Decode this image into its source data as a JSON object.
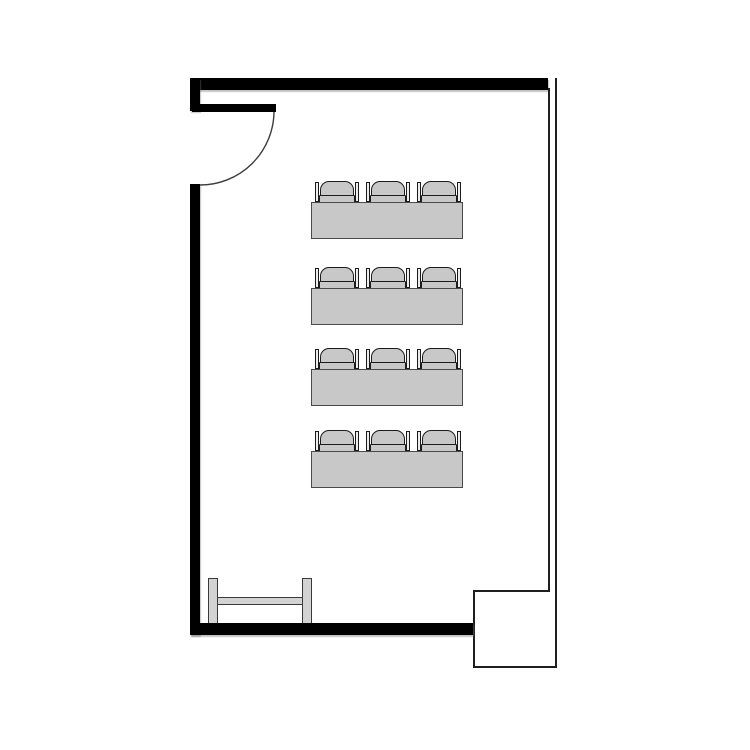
{
  "scene": {
    "kind": "floor-plan",
    "room": "classroom",
    "background": "#ffffff",
    "canvas": {
      "width": 750,
      "height": 750
    }
  },
  "palette": {
    "wall": "#000000",
    "thin_line": "#1f1f1f",
    "door_arc": "#3c3c3c",
    "furniture_fill": "#c8c8c8",
    "furniture_border": "#4a4a4a",
    "chair_border": "#1b1b1b",
    "armrest_fill": "#ededed",
    "bench_fill": "#d3d3d3",
    "bench_border": "#3a3a3a"
  },
  "walls": {
    "top": {
      "x": 190,
      "y": 78,
      "w": 358,
      "h": 12,
      "thick": true
    },
    "left_upper": {
      "x": 190,
      "y": 78,
      "w": 10,
      "h": 33,
      "thick": true
    },
    "left_lower": {
      "x": 190,
      "y": 184,
      "w": 10,
      "h": 451,
      "thick": true
    },
    "bottom": {
      "x": 190,
      "y": 623,
      "w": 283,
      "h": 12,
      "thick": true
    },
    "right_inner": {
      "x": 548,
      "y": 88,
      "w": 2,
      "h": 503,
      "thick": false
    },
    "right_outer": {
      "x": 555,
      "y": 78,
      "w": 2,
      "h": 590,
      "thick": false
    }
  },
  "door": {
    "panel": {
      "x": 192,
      "y": 104,
      "w": 84,
      "h": 8
    },
    "swing_arc": {
      "cx": 200,
      "cy": 111,
      "r": 74
    }
  },
  "alcove": {
    "top_edge": {
      "x": 473,
      "y": 590,
      "w": 77,
      "h": 2
    },
    "left_edge": {
      "x": 473,
      "y": 590,
      "w": 2,
      "h": 78
    },
    "bottom_edge": {
      "x": 473,
      "y": 666,
      "w": 84,
      "h": 2
    }
  },
  "seating": {
    "rows": [
      {
        "table": {
          "x": 311,
          "y": 202,
          "w": 152,
          "h": 37
        },
        "chairs": 3
      },
      {
        "table": {
          "x": 311,
          "y": 288,
          "w": 152,
          "h": 37
        },
        "chairs": 3
      },
      {
        "table": {
          "x": 311,
          "y": 369,
          "w": 152,
          "h": 37
        },
        "chairs": 3
      },
      {
        "table": {
          "x": 311,
          "y": 451,
          "w": 152,
          "h": 37
        },
        "chairs": 3
      }
    ],
    "chair": {
      "w": 44,
      "h": 22,
      "offsets": [
        4,
        55,
        106
      ]
    },
    "total_seats": 12
  },
  "bench": {
    "posts": [
      {
        "x": 208,
        "y": 578,
        "w": 10,
        "h": 46
      },
      {
        "x": 302,
        "y": 578,
        "w": 10,
        "h": 46
      }
    ],
    "bar": {
      "x": 208,
      "y": 597,
      "w": 104,
      "h": 8
    }
  }
}
